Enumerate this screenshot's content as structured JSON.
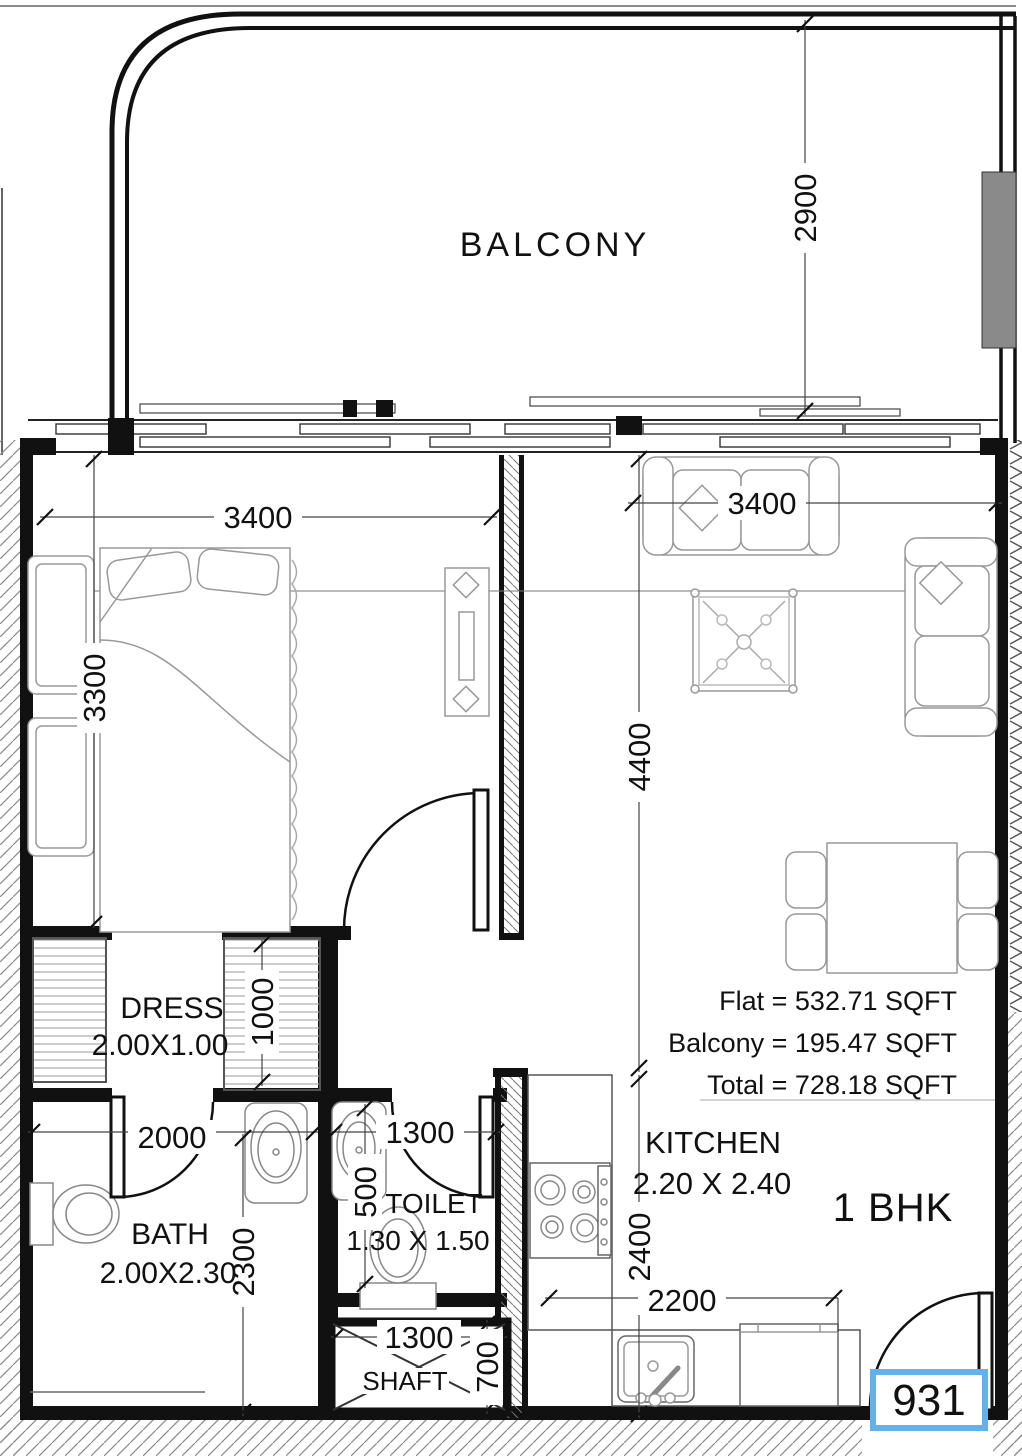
{
  "plan": {
    "unit_type": "1 BHK",
    "unit_number": "931",
    "areas": {
      "flat_label": "Flat = 532.71 SQFT",
      "balcony_label": "Balcony = 195.47 SQFT",
      "total_label": "Total = 728.18 SQFT"
    },
    "rooms": {
      "balcony": {
        "label": "BALCONY"
      },
      "kitchen": {
        "label": "KITCHEN",
        "size": "2.20 X 2.40"
      },
      "bath": {
        "label": "BATH",
        "size": "2.00X2.30"
      },
      "dress": {
        "label": "DRESS",
        "size": "2.00X1.00"
      },
      "toilet": {
        "label": "TOILET",
        "size": "1.30 X 1.50"
      },
      "shaft": {
        "label": "SHAFT"
      }
    },
    "dimensions": {
      "balcony_depth": "2900",
      "bedroom_width": "3400",
      "bedroom_length": "3300",
      "living_width": "3400",
      "living_length": "4400",
      "dress_depth": "1000",
      "bath_width": "2000",
      "bath_length": "2300",
      "toilet_width": "1300",
      "toilet_depth": "500",
      "kitchen_width": "2200",
      "kitchen_length": "2400",
      "shaft_width": "1300",
      "shaft_depth": "700"
    },
    "colors": {
      "wall": "#111111",
      "area_text": "#e63c2f",
      "unit_type_text": "#3d2cea",
      "unit_number_text": "#64b0ea",
      "column_fill": "#8a8a8a"
    }
  }
}
